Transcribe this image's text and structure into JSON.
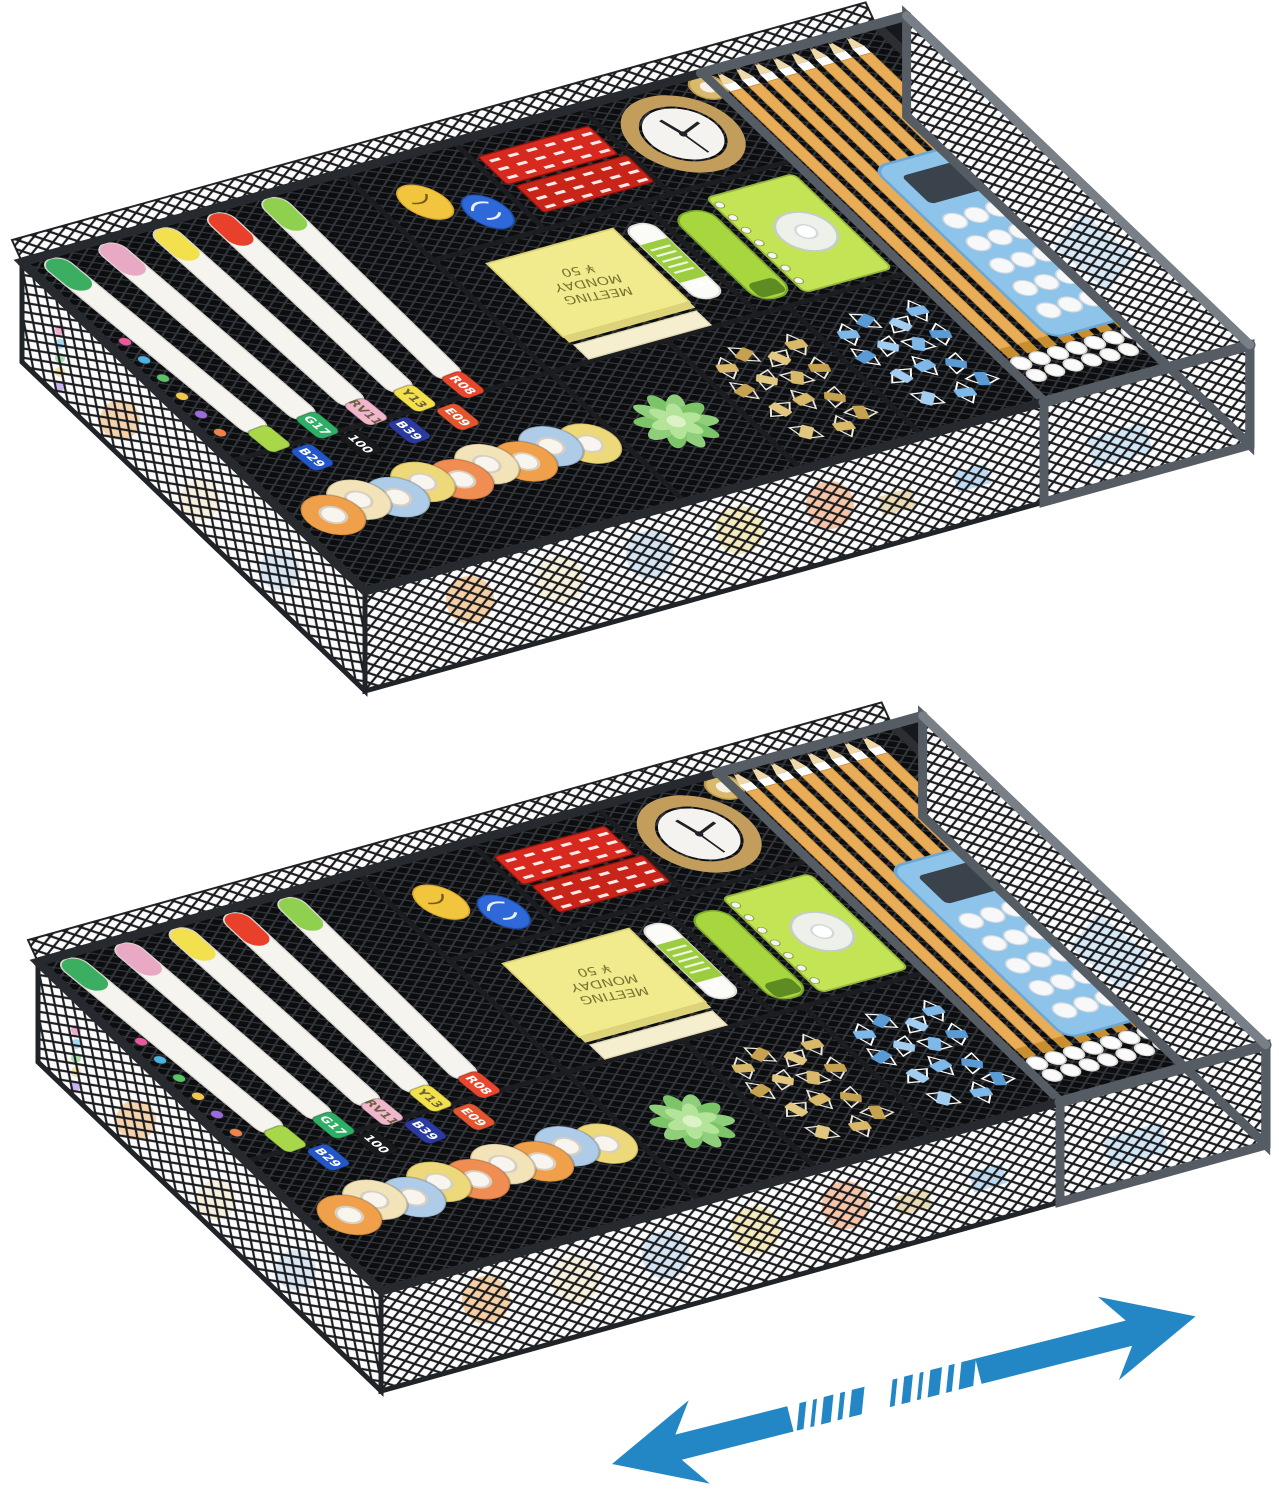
{
  "product": {
    "description": "Two expandable black mesh under-drawer organizers filled with office supplies, with a blue double-headed expand arrow",
    "organizer_count": 2
  },
  "colors": {
    "background": "#ffffff",
    "mesh_floor": "#0c0d0f",
    "mesh_floor_line": "#33363c",
    "wall_bg": "#fcfcfc",
    "wall_line": "#1a1c1f",
    "rim_dark": "#26292e",
    "frame_gray": "#565c63",
    "frame_gray_light": "#787f87",
    "arrow": "#2287c4"
  },
  "markers": {
    "count": 5,
    "body_color": "#f5f4ef",
    "tip_colors": [
      "#3cae62",
      "#e9a8c4",
      "#f2e14c",
      "#e8402a",
      "#8fd14f"
    ],
    "caps_row1": [
      {
        "code": "",
        "color": "#a8d84a"
      },
      {
        "code": "G17",
        "color": "#2fae66"
      },
      {
        "code": "RV11",
        "color": "#f0b6cc"
      },
      {
        "code": "Y13",
        "color": "#f2e14c"
      },
      {
        "code": "R08",
        "color": "#e8472e"
      }
    ],
    "caps_row2": [
      {
        "code": "B29",
        "color": "#2356c8"
      },
      {
        "code": "100",
        "color": "#191a1c"
      },
      {
        "code": "B39",
        "color": "#2b3a9e"
      },
      {
        "code": "E09",
        "color": "#e2552e"
      }
    ]
  },
  "colored_pencil_tip_colors": [
    "#e85a9c",
    "#4ab4e6",
    "#58c464",
    "#f2c84a",
    "#9a6ae0",
    "#f0824a"
  ],
  "washi_tapes": {
    "count": 9,
    "colors": [
      "#f0a04a",
      "#f3e3b8",
      "#aecbe8",
      "#edd87a",
      "#ef8d52",
      "#f3e3b8",
      "#f0a04a",
      "#aecbe8",
      "#edd87a"
    ],
    "hole_color": "#f8f5ee"
  },
  "egg_highlighters": {
    "yellow": "#f2c53e",
    "blue": "#2f68d8"
  },
  "staples": {
    "box_count": 2,
    "box_color": "#d7291e",
    "box_color_2": "#c92418"
  },
  "clock": {
    "ring_color": "#c29d5c",
    "face_color": "#f4f3ef",
    "hand_color": "#1f2125"
  },
  "sticky_note": {
    "lines": [
      "MEETING",
      "MONDAY",
      "¥ 50"
    ],
    "pad_color": "#f1eb8d",
    "ink_color": "#7a7433",
    "mini_pad_color": "#f5efcf"
  },
  "glue_stick": {
    "label": "CE",
    "body_color": "#fbfbf8",
    "label_color": "#9bcd3e"
  },
  "stapler": {
    "color": "#a7d63f"
  },
  "notebook": {
    "cover_color": "#c3e455",
    "spiral_color": "#f5f5f5"
  },
  "correction_tape": {
    "disc_color": "#f1f3f5",
    "rim_color": "#c6ccd2"
  },
  "succulent": {
    "outer_leaf": "#8fce7a",
    "outer_leaf_2": "#7cc468",
    "inner_leaf": "#b4e49a",
    "center": "#daf2c4"
  },
  "binder_clips_gold": {
    "count": 14,
    "colors": [
      "#d8b96a",
      "#c6a14f",
      "#e2c780"
    ],
    "wire_color": "#efe9dc"
  },
  "binder_clips_blue": {
    "count": 14,
    "colors": [
      "#7db8e8",
      "#5b9bd4",
      "#a2cdf0"
    ],
    "wire_color": "#ffffff"
  },
  "pencils": {
    "count": 8,
    "body_color": "#e9ad58",
    "ferrule_color": "#c98f2e",
    "eraser_color": "#fdfdfd",
    "wood_color": "#f0d9a8"
  },
  "calculator": {
    "body_color": "#8ec4ea",
    "screen_color": "#3a434c",
    "button_color": "#f7f8f9",
    "button_rows": 5,
    "button_cols": 4
  },
  "gold_tape_roll": {
    "color": "#d9b96c"
  },
  "expand_arrow": {
    "color": "#2287c4",
    "direction": "double-headed diagonal"
  }
}
